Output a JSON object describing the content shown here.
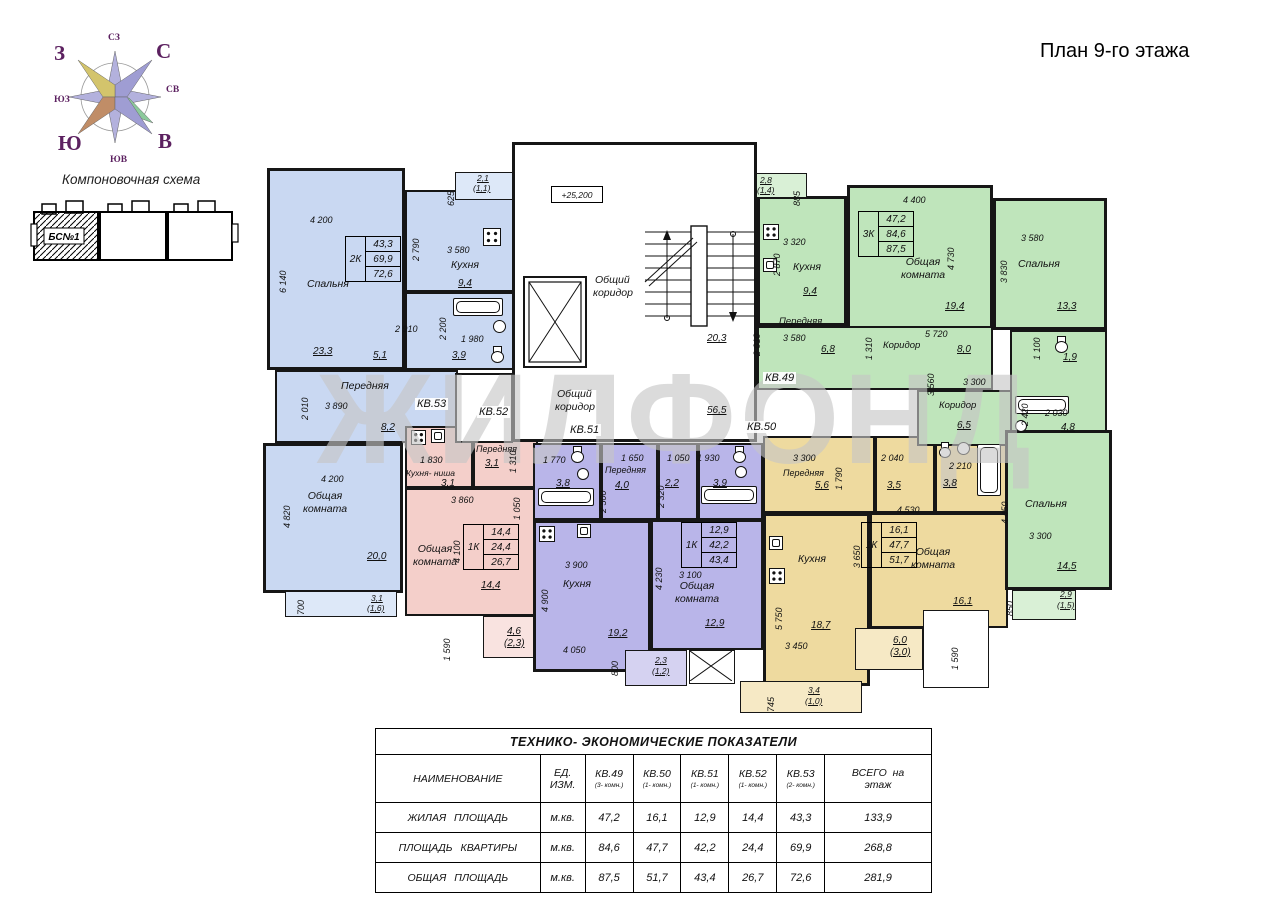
{
  "title": "План 9-го этажа",
  "watermark": "ЖИЛФОНД",
  "compass": {
    "n": "С",
    "e": "В",
    "s": "Ю",
    "w": "З",
    "nw": "СЗ",
    "ne": "СВ",
    "se": "ЮВ",
    "sw": "ЮЗ"
  },
  "scheme": {
    "title": "Компоновочная схема",
    "block": "БС№1"
  },
  "core": {
    "level": "+25,200",
    "corridor_top_l1": "Общий",
    "corridor_top_l2": "коридор",
    "stairs_area": "20,3",
    "corridor_main_l1": "Общий",
    "corridor_main_l2": "коридор",
    "corridor_main_area": "56,5"
  },
  "kv53": {
    "label": "КВ.53",
    "type": "2К",
    "stats": [
      "43,3",
      "69,9",
      "72,6"
    ],
    "bedroom": {
      "name": "Спальня",
      "area": "23,3",
      "w": "4 200",
      "h": "6 140"
    },
    "kitchen": {
      "name": "Кухня",
      "area": "9,4",
      "w": "3 580",
      "h": "2 790"
    },
    "corridor": {
      "area": "5,1",
      "w": "2 910"
    },
    "bath": {
      "area": "3,9",
      "w": "1 980",
      "h": "2 200"
    },
    "hall": {
      "name": "Передняя",
      "area": "8,2",
      "w": "3 890",
      "h": "2 010"
    },
    "living": {
      "name": "Общая комната",
      "area": "20,0",
      "w": "4 200",
      "h": "4 820"
    },
    "balc_top": {
      "area": "2,1",
      "area2": "(1,1)",
      "w": "625"
    },
    "balc_bot": {
      "area": "3,1",
      "area2": "(1,6)",
      "w": "700"
    }
  },
  "kv52": {
    "label": "КВ.52",
    "type": "1К",
    "stats": [
      "14,4",
      "24,4",
      "26,7"
    ],
    "kitchenette": {
      "name": "Кухня- ниша",
      "area": "3,1",
      "w": "1 830"
    },
    "hall": {
      "name": "Передняя",
      "area": "3,1",
      "h": "1 310"
    },
    "living": {
      "name": "Общая комната",
      "area": "14,4",
      "w": "3 860",
      "h": "4 100"
    },
    "d1050": "1 050",
    "balc": {
      "area": "4,6",
      "area2": "(2,3)",
      "h": "1 590"
    }
  },
  "kv51": {
    "label": "КВ.51",
    "type": "1К",
    "stats": [
      "12,9",
      "42,2",
      "43,4"
    ],
    "bath1": {
      "area": "3,8",
      "w": "1 770"
    },
    "hall": {
      "name": "Передняя",
      "area": "4,0",
      "w": "1 650",
      "h": "2 500"
    },
    "wc": {
      "area": "2,2",
      "h": "2 320"
    },
    "bath2": {
      "area": "3,9",
      "w": "1 930",
      "d": "1 050"
    },
    "kitchen": {
      "name": "Кухня",
      "area": "19,2",
      "w": "3 900",
      "h": "4 900",
      "w2": "4 050"
    },
    "living": {
      "name": "Общая комната",
      "area": "12,9",
      "w": "3 100",
      "h": "4 230"
    },
    "balc": {
      "area": "2,3",
      "area2": "(1,2)",
      "h": "800"
    }
  },
  "kv50": {
    "label": "КВ.50",
    "type": "1К",
    "stats": [
      "16,1",
      "47,7",
      "51,7"
    ],
    "hall": {
      "name": "Передняя",
      "area": "5,6",
      "w": "3 300",
      "h": "1 790"
    },
    "wc": {
      "area": "3,5",
      "w": "2 040"
    },
    "bath": {
      "area": "3,8",
      "w": "2 210"
    },
    "kitchen": {
      "name": "Кухня",
      "area": "18,7",
      "h": "5 750",
      "w": "3 450"
    },
    "living": {
      "name": "Общая комната",
      "area": "16,1",
      "w": "4 530",
      "h": "3 650"
    },
    "balc1": {
      "area": "6,0",
      "area2": "(3,0)"
    },
    "balc2": {
      "area": "3,4",
      "area2": "(1,0)",
      "w": "745"
    },
    "d1590": "1 590"
  },
  "kv49": {
    "label": "КВ.49",
    "type": "3К",
    "stats": [
      "47,2",
      "84,6",
      "87,5"
    ],
    "balc_top": {
      "area": "2,8",
      "area2": "(1,4)",
      "w": "885"
    },
    "kitchen": {
      "name": "Кухня",
      "area": "9,4",
      "w": "3 320",
      "h": "2 870"
    },
    "living": {
      "name": "Общая комната",
      "area": "19,4",
      "w": "4 400",
      "h": "4 730"
    },
    "bedroom1": {
      "name": "Спальня",
      "area": "13,3",
      "w": "3 580",
      "h": "3 830"
    },
    "hall": {
      "name": "Передняя",
      "area": "6,8",
      "w": "3 580",
      "h": "2 010"
    },
    "corridor1": {
      "name": "Коридор",
      "area": "8,0",
      "w": "5 720",
      "h": "1 310"
    },
    "corridor2": {
      "name": "Коридор",
      "area": "6,5",
      "w": "3 300",
      "h": "3 560"
    },
    "wc": {
      "area": "1,9",
      "h": "1 100"
    },
    "bath": {
      "area": "4,8",
      "w": "2 030",
      "h": "2 420"
    },
    "bedroom2": {
      "name": "Спальня",
      "area": "14,5",
      "h": "4 450",
      "w": "3 300"
    },
    "balc_bot": {
      "area": "2,9",
      "area2": "(1,5)",
      "w": "850"
    }
  },
  "table": {
    "title": "ТЕХНИКО- ЭКОНОМИЧЕСКИЕ  ПОКАЗАТЕЛИ",
    "col_name": "НАИМЕНОВАНИЕ",
    "unit_l1": "ЕД.",
    "unit_l2": "ИЗМ.",
    "cols": [
      {
        "id": "КВ.49",
        "sub": "(3- комн.)"
      },
      {
        "id": "КВ.50",
        "sub": "(1- комн.)"
      },
      {
        "id": "КВ.51",
        "sub": "(1- комн.)"
      },
      {
        "id": "КВ.52",
        "sub": "(1- комн.)"
      },
      {
        "id": "КВ.53",
        "sub": "(2- комн.)"
      }
    ],
    "total_l1": "ВСЕГО  на",
    "total_l2": "этаж",
    "rows": [
      {
        "name": "ЖИЛАЯ  ПЛОЩАДЬ",
        "unit": "м.кв.",
        "values": [
          "47,2",
          "16,1",
          "12,9",
          "14,4",
          "43,3",
          "133,9"
        ]
      },
      {
        "name": "ПЛОЩАДЬ  КВАРТИРЫ",
        "unit": "м.кв.",
        "values": [
          "84,6",
          "47,7",
          "42,2",
          "24,4",
          "69,9",
          "268,8"
        ]
      },
      {
        "name": "ОБЩАЯ  ПЛОЩАДЬ",
        "unit": "м.кв.",
        "values": [
          "87,5",
          "51,7",
          "43,4",
          "26,7",
          "72,6",
          "281,9"
        ]
      }
    ]
  }
}
